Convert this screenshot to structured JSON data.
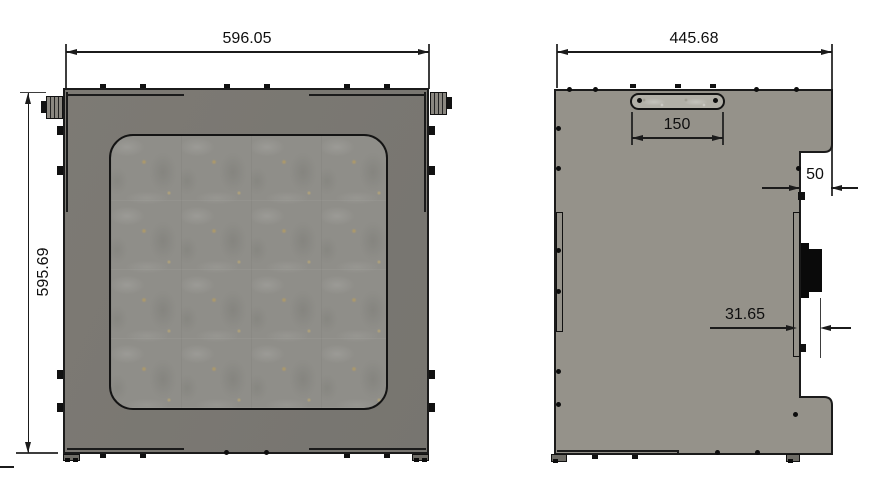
{
  "drawing": {
    "title": "sheet-metal enclosure panel drawing, front and side views",
    "front_view": {
      "width_dim": "596.05",
      "height_dim": "595.69"
    },
    "side_view": {
      "width_dim": "445.68",
      "slot_dim": "150",
      "step_dim": "50",
      "offset_dim": "31.65"
    },
    "colors": {
      "line": "#1b1b1b",
      "front_panel": "#7a7772",
      "side_panel": "#95928a",
      "window_fill": "#8f8e89",
      "slot_fill": "#b2b0a8",
      "background": "#ffffff"
    }
  }
}
